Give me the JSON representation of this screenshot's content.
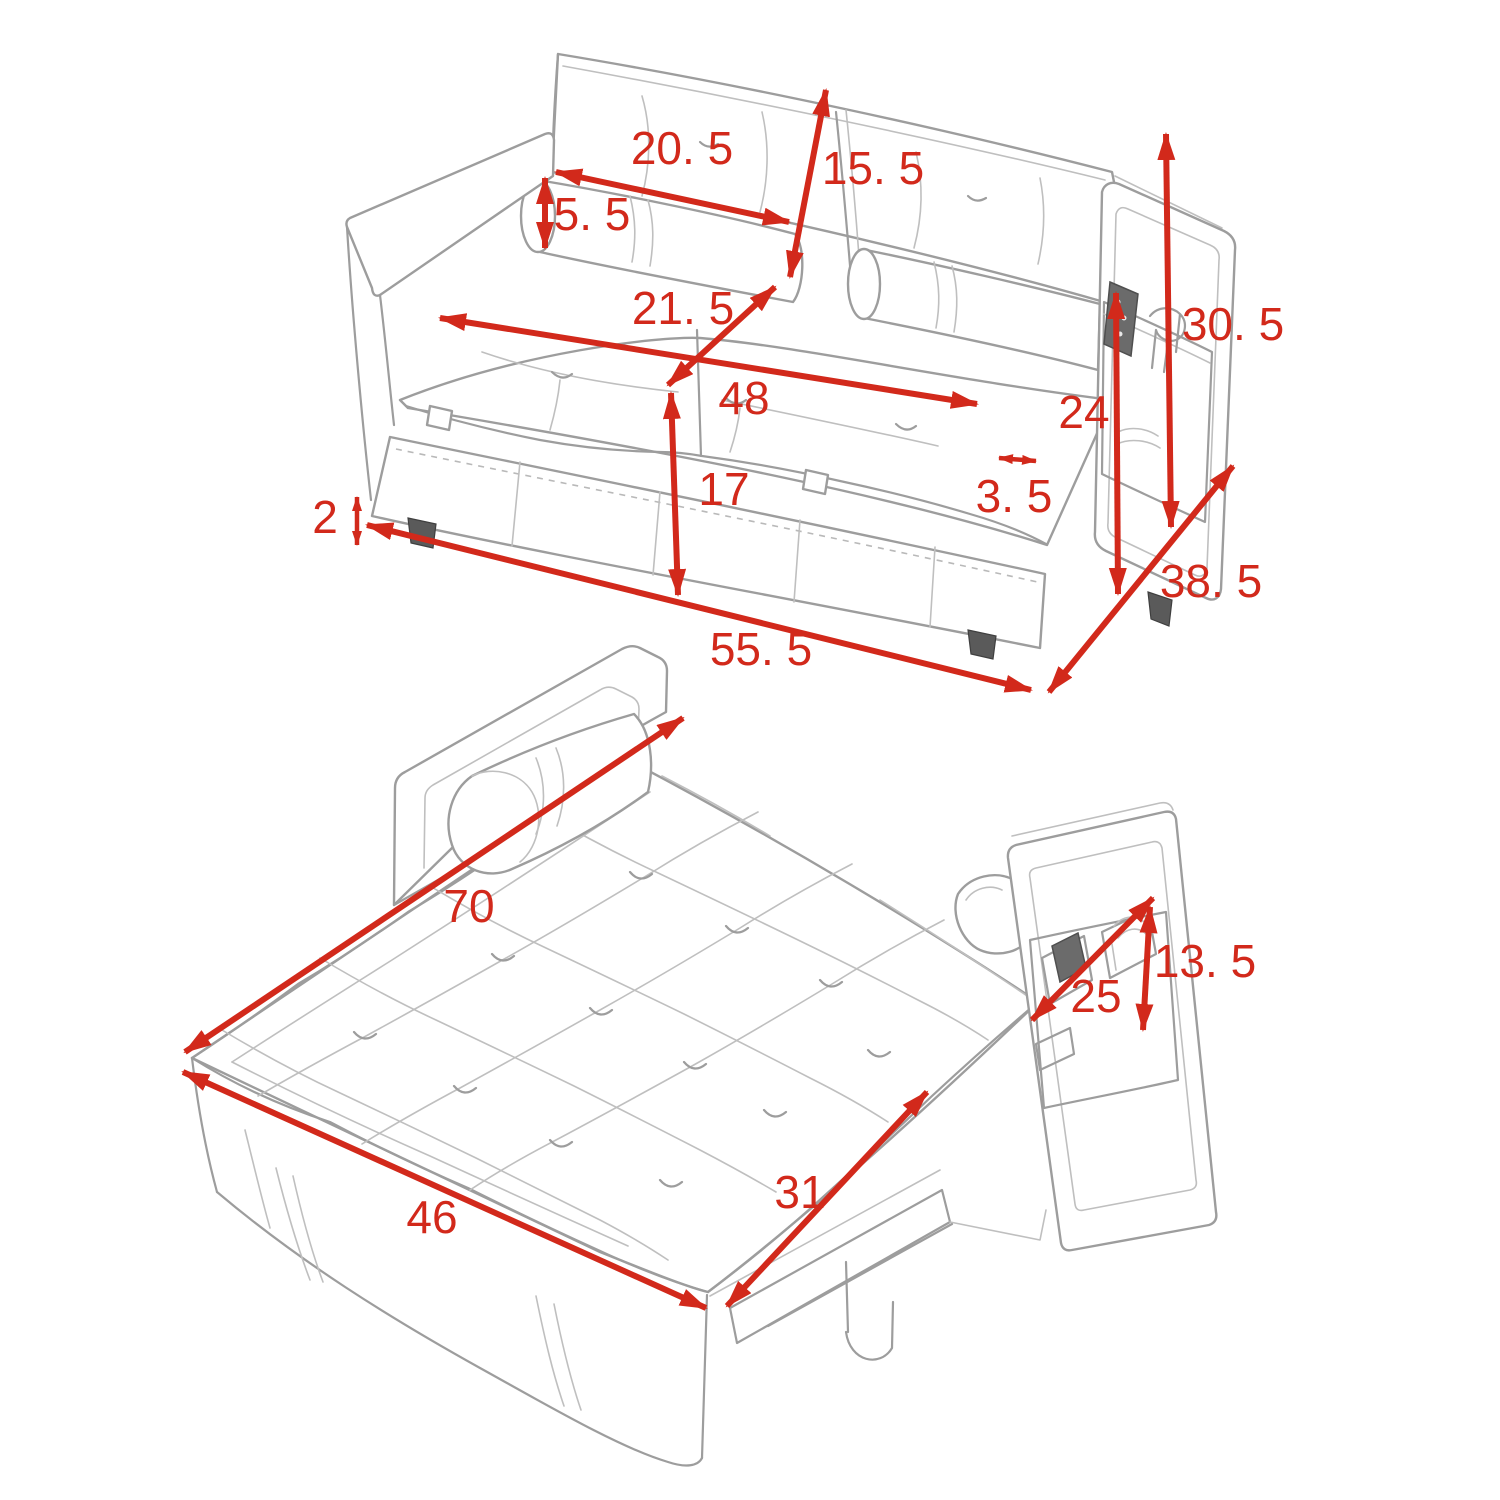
{
  "page": {
    "kind": "product-dimension-diagram",
    "background": "#ffffff"
  },
  "style": {
    "accent": "#d2291b",
    "sketch": "#9d9d9d"
  },
  "views": [
    {
      "id": "sofa-upright",
      "name": "sofa compact view",
      "dimensions": [
        {
          "id": "back-cushion-width",
          "label": "20. 5",
          "value": 20.5,
          "x1": 556,
          "y1": 172,
          "x2": 789,
          "y2": 222,
          "lx": 682,
          "ly": 148
        },
        {
          "id": "back-cushion-height",
          "label": "15. 5",
          "value": 15.5,
          "x1": 826,
          "y1": 90,
          "x2": 790,
          "y2": 277,
          "lx": 873,
          "ly": 168
        },
        {
          "id": "bolster-diameter",
          "label": "5. 5",
          "value": 5.5,
          "x1": 545,
          "y1": 178,
          "x2": 545,
          "y2": 248,
          "lx": 592,
          "ly": 214
        },
        {
          "id": "seat-depth",
          "label": "21. 5",
          "value": 21.5,
          "x1": 775,
          "y1": 287,
          "x2": 668,
          "y2": 385,
          "lx": 683,
          "ly": 308
        },
        {
          "id": "seat-width",
          "label": "48",
          "value": 48,
          "x1": 440,
          "y1": 318,
          "x2": 977,
          "y2": 404,
          "lx": 744,
          "ly": 398
        },
        {
          "id": "base-height",
          "label": "17",
          "value": 17,
          "x1": 671,
          "y1": 393,
          "x2": 678,
          "y2": 595,
          "lx": 724,
          "ly": 489
        },
        {
          "id": "armrest-thickness",
          "label": "3. 5",
          "value": 3.5,
          "x1": 999,
          "y1": 458,
          "x2": 1036,
          "y2": 461,
          "lx": 1014,
          "ly": 496,
          "small": true
        },
        {
          "id": "side-pocket-height",
          "label": "24",
          "value": 24,
          "x1": 1116,
          "y1": 293,
          "x2": 1118,
          "y2": 594,
          "lx": 1084,
          "ly": 412
        },
        {
          "id": "back-total-height",
          "label": "30. 5",
          "value": 30.5,
          "x1": 1166,
          "y1": 134,
          "x2": 1171,
          "y2": 527,
          "lx": 1233,
          "ly": 324
        },
        {
          "id": "leg-height",
          "label": "2",
          "value": 2,
          "x1": 357,
          "y1": 497,
          "x2": 357,
          "y2": 545,
          "lx": 325,
          "ly": 517,
          "small": true
        },
        {
          "id": "overall-depth",
          "label": "38. 5",
          "value": 38.5,
          "x1": 1049,
          "y1": 692,
          "x2": 1233,
          "y2": 466,
          "lx": 1211,
          "ly": 581
        },
        {
          "id": "overall-width",
          "label": "55. 5",
          "value": 55.5,
          "x1": 367,
          "y1": 525,
          "x2": 1031,
          "y2": 690,
          "lx": 761,
          "ly": 649
        }
      ]
    },
    {
      "id": "sofa-bed-open",
      "name": "pulled out bed view",
      "dimensions": [
        {
          "id": "bed-length",
          "label": "70",
          "value": 70,
          "x1": 683,
          "y1": 718,
          "x2": 185,
          "y2": 1052,
          "lx": 469,
          "ly": 906
        },
        {
          "id": "bed-width",
          "label": "46",
          "value": 46,
          "x1": 183,
          "y1": 1072,
          "x2": 706,
          "y2": 1308,
          "lx": 432,
          "ly": 1217
        },
        {
          "id": "pullout-depth",
          "label": "31",
          "value": 31,
          "x1": 927,
          "y1": 1092,
          "x2": 727,
          "y2": 1306,
          "lx": 800,
          "ly": 1192
        },
        {
          "id": "arm-pocket-height",
          "label": "13. 5",
          "value": 13.5,
          "x1": 1150,
          "y1": 907,
          "x2": 1143,
          "y2": 1030,
          "lx": 1205,
          "ly": 961
        },
        {
          "id": "arm-pocket-width",
          "label": "25",
          "value": 25,
          "x1": 1153,
          "y1": 898,
          "x2": 1032,
          "y2": 1020,
          "lx": 1096,
          "ly": 996
        }
      ]
    }
  ]
}
